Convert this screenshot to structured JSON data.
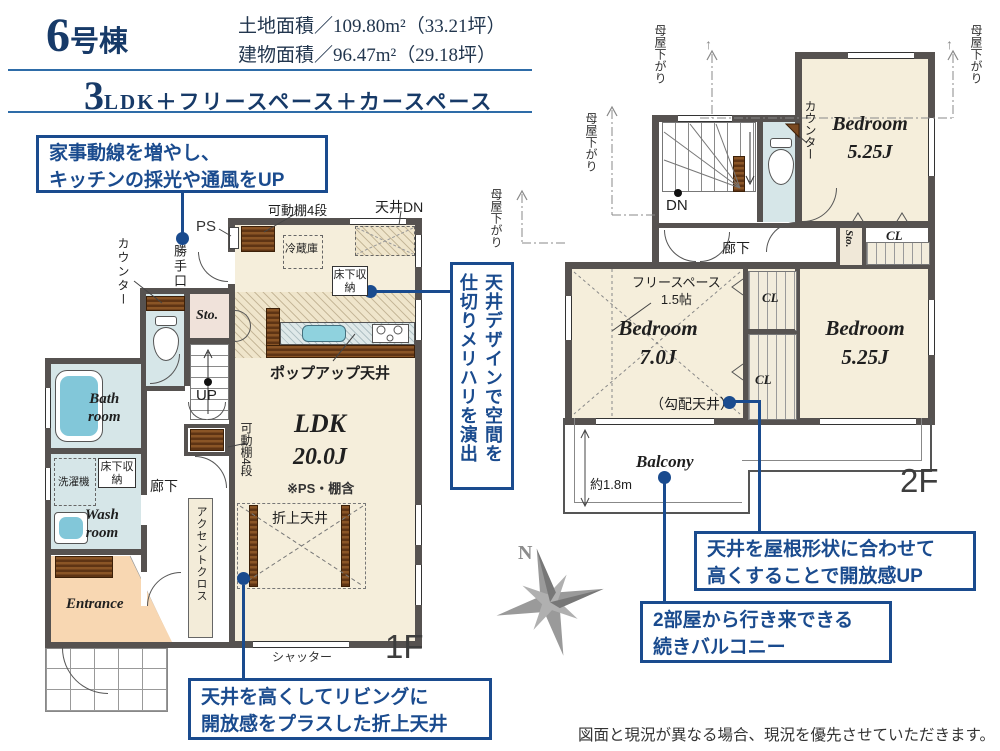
{
  "header": {
    "num": "6",
    "suffix": "号棟",
    "land": "土地面積／109.80m²（33.21坪）",
    "bldg": "建物面積／96.47m²（29.18坪）",
    "plan_num": "3",
    "plan_text": "LDK＋フリースペース＋カースペース"
  },
  "callouts": {
    "kitchen_l1": "家事動線を増やし、",
    "kitchen_l2": "キッチンの採光や通風をUP",
    "ceiling_l1": "天井デザインで空間を",
    "ceiling_l2": "仕切りメリハリを演出",
    "oriage_l1": "天井を高くしてリビングに",
    "oriage_l2": "開放感をプラスした折上天井",
    "roof_l1": "天井を屋根形状に合わせて",
    "roof_l2": "高くすることで開放感UP",
    "balcony_l1": "2部屋から行き来できる",
    "balcony_l2": "続きバルコニー"
  },
  "f1": {
    "label": "1F",
    "ldk": "LDK",
    "ldk_size": "20.0J",
    "ldk_note": "※PS・棚含",
    "bath_l1": "Bath",
    "bath_l2": "room",
    "wash_l1": "Wash",
    "wash_l2": "room",
    "entrance": "Entrance",
    "sto": "Sto.",
    "hall": "廊下",
    "ps": "PS",
    "back_door": "勝手口",
    "counter": "カウンター",
    "shelf": "可動棚4段",
    "ceiling_dn": "天井DN",
    "fridge": "冷蔵庫",
    "underfloor": "床下収納",
    "up": "UP",
    "washer": "洗濯機",
    "accent": "アクセントクロス",
    "popup": "ポップアップ天井",
    "oriage": "折上天井",
    "shutter": "シャッター"
  },
  "f2": {
    "label": "2F",
    "bedroom": "Bedroom",
    "b1_size": "5.25J",
    "b2_size": "7.0J",
    "b3_size": "5.25J",
    "free_l1": "フリースペース",
    "free_l2": "1.5帖",
    "slope": "（勾配天井）",
    "balcony": "Balcony",
    "dim": "約1.8m",
    "moya": "母屋下がり",
    "counter": "カウンター",
    "dn": "DN",
    "hall": "廊下",
    "sto": "Sto.",
    "cl": "CL"
  },
  "misc": {
    "arrow_up": "↑"
  },
  "compass_n": "N",
  "disclaimer": "図面と現況が異なる場合、現況を優先させていただきます。"
}
